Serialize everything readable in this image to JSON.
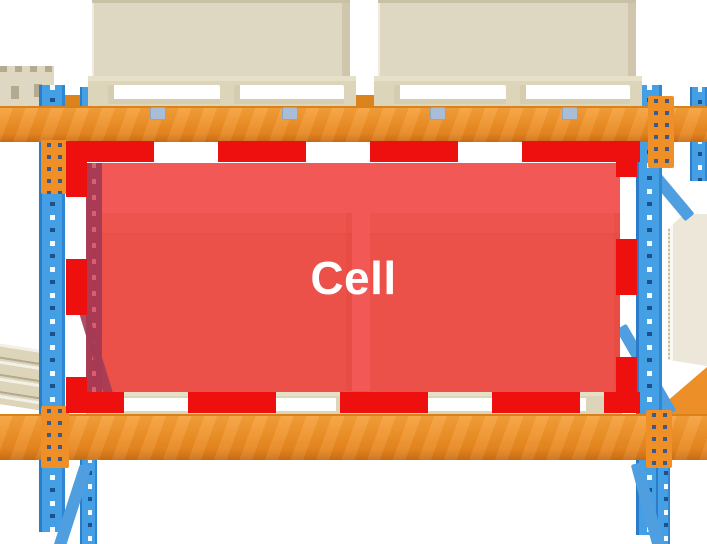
{
  "diagram": {
    "cell_label": "Cell",
    "type": "warehouse-pallet-rack-illustration"
  },
  "colors": {
    "cell_fill": "#ee2a26",
    "cell_dash": "#ee0f0f",
    "beam": "#ec8f28",
    "beam_dark": "#c96d12",
    "upright": "#459fe5",
    "upright_edge": "#2a7cc9",
    "cargo": "#ded7c2",
    "cargo_top": "#eee9d9",
    "pallet": "#ddd5ba",
    "pallet_light": "#e7e0c9",
    "rear_post": "#a83a55",
    "clip": "#a9bed6",
    "label": "#ffffff",
    "bg": "#ffffff"
  },
  "scene": {
    "parts": [
      "upper-beam",
      "lower-beam",
      "left-upright",
      "right-upright",
      "cell-highlight-dashed-border",
      "cell-highlight-fill",
      "stored-boxes-in-cell",
      "pallet-in-cell",
      "boxes-on-upper-level",
      "pallets-on-upper-level",
      "neighbour-box-top-left",
      "neighbour-pallet-left",
      "neighbour-box-right"
    ]
  }
}
